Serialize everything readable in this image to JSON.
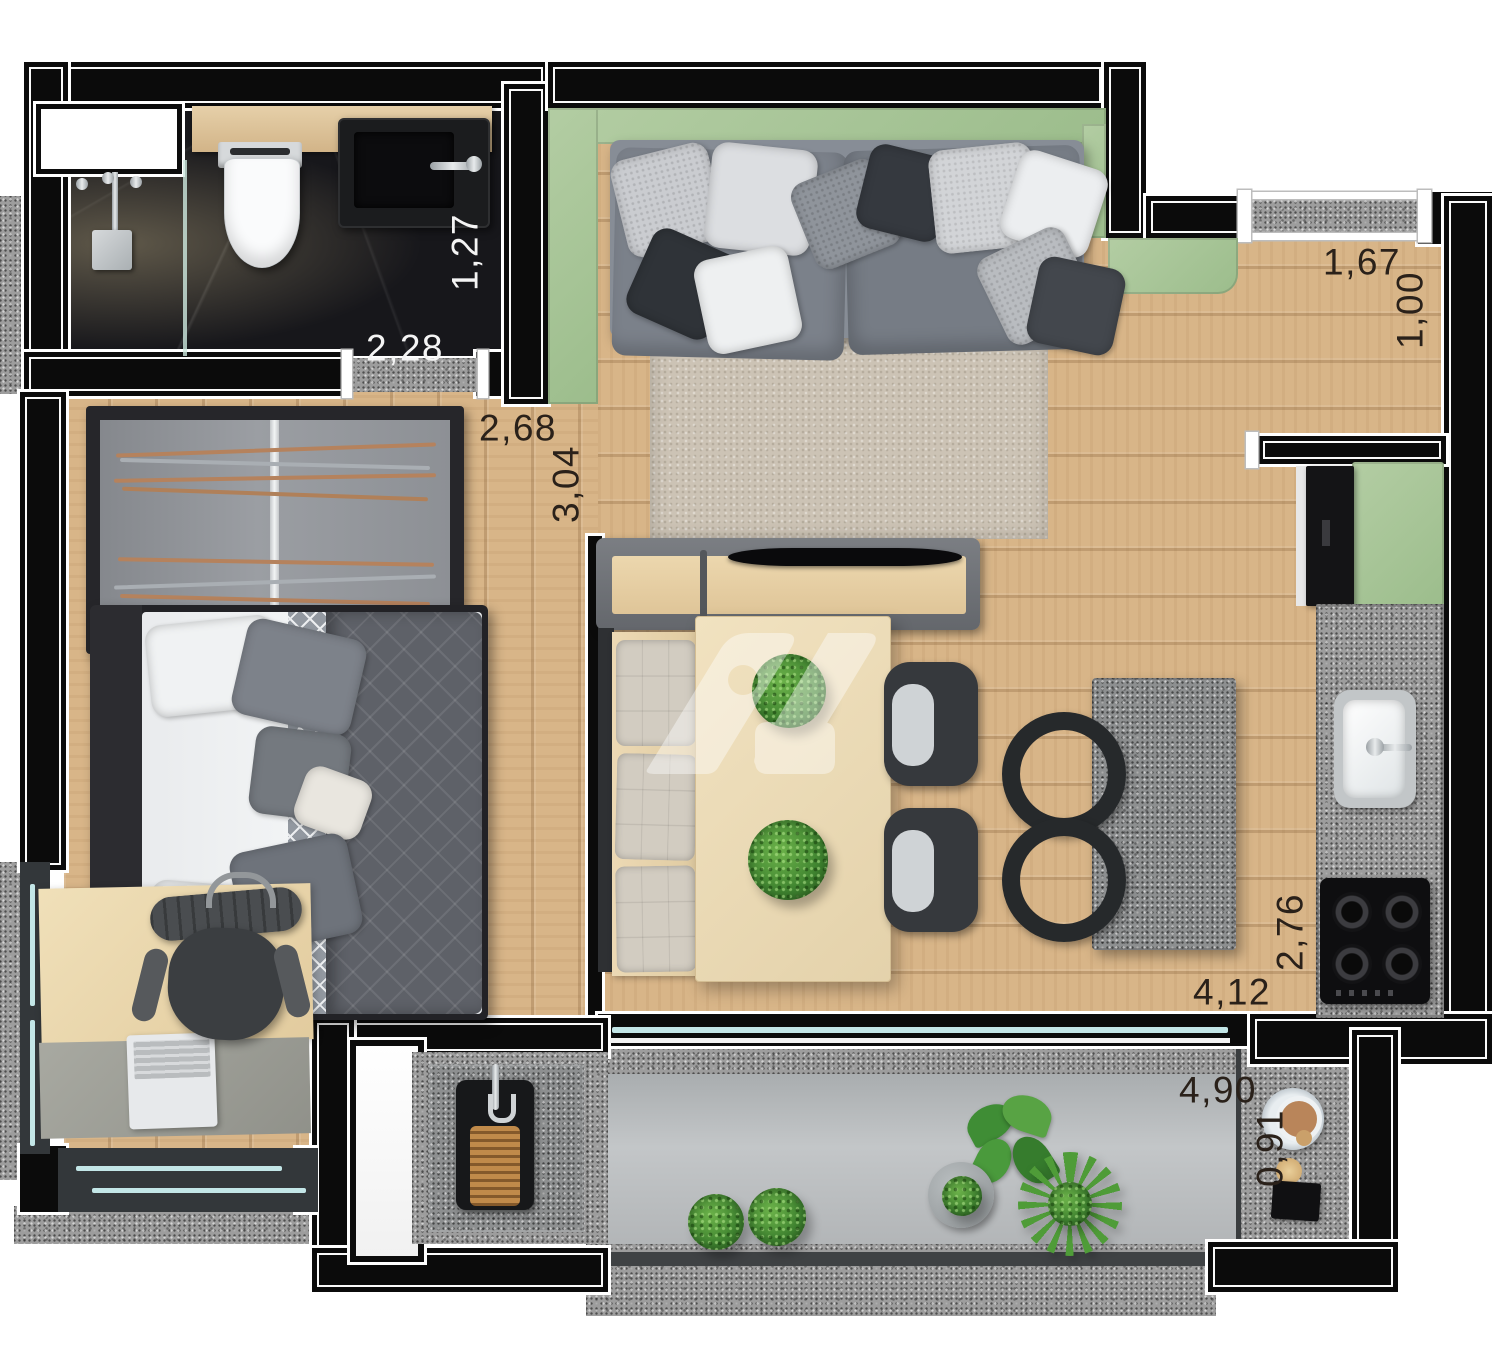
{
  "plan": {
    "watermark": {
      "name": "developer-logo-monogram"
    },
    "dimensions": {
      "bathroom_width": "2,28",
      "bathroom_depth": "1,27",
      "hall_width": "2,68",
      "hall_depth": "3,04",
      "entry_width": "1,67",
      "entry_depth": "1,00",
      "kitchen_depth": "2,76",
      "kitchen_width": "4,12",
      "balcony_width": "4,90",
      "balcony_depth": "0,91"
    },
    "colors": {
      "wall": "#0b0b0b",
      "accent_green": "#9cbd8c",
      "wood": "#d8b588",
      "marble": "#17171b",
      "granite": "#9d9d9d",
      "concrete": "#b7babc",
      "label_dark": "#2a211a",
      "label_light": "#f4f4f4"
    }
  }
}
